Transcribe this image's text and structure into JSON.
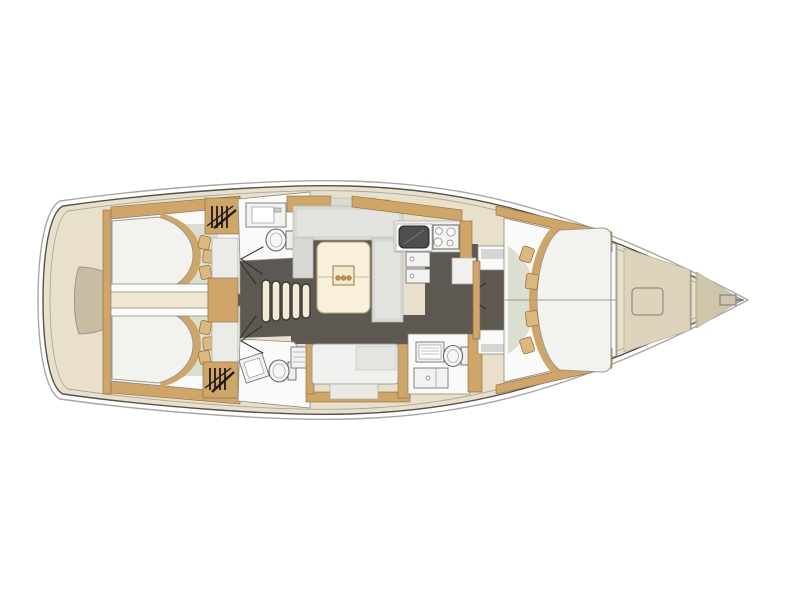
{
  "figure": {
    "type": "floor-plan-diagram",
    "subject": "sailing yacht interior layout, top-down view",
    "orientation": "bow pointing right, stern at left",
    "visible_text_labels": []
  },
  "palette": {
    "hullBeige": "#e9e0cb",
    "hullOutline": "#55524a",
    "deckLine": "#a8a8a0",
    "woodTan": "#d0a568",
    "woodDark": "#8a6a3c",
    "floorDark": "#5d5852",
    "roomWhite": "#fafaf8",
    "mattressWhite": "#f2f2ef",
    "seatGray": "#d7d7d4",
    "seatGrayLight": "#e3e3e0",
    "tableCream": "#f8f0da",
    "sage": "#dadfd0",
    "sternPad": "#c8bca2",
    "foredeckPanel": "#ded4bc",
    "anchorLocker": "#cfc5ab",
    "sinkDark": "#4e4e4e",
    "lineDark": "#2e2c28",
    "pillowTan": "#ddb87c",
    "outlineThin": "#8c8b84"
  },
  "areas": {
    "stern_platform": {
      "fixtures": [
        "swim-platform-pad"
      ]
    },
    "aft_cabin_port": {
      "fixtures": [
        "double-berth",
        "pillows-3",
        "hanging-locker-symbol",
        "side-unit"
      ]
    },
    "aft_cabin_starboard": {
      "fixtures": [
        "double-berth",
        "pillows-3",
        "hanging-locker-symbol",
        "side-unit"
      ]
    },
    "engine_compartment": {
      "fixtures": [
        "engine-box"
      ]
    },
    "companionway": {
      "steps": 5
    },
    "aft_head_port": {
      "fixtures": [
        "washbasin",
        "toilet"
      ]
    },
    "aft_head_starboard": {
      "fixtures": [
        "washbasin",
        "toilet",
        "shower-seat"
      ]
    },
    "salon": {
      "fixtures": [
        "u-shaped-settee",
        "table",
        "tray-with-3-cups"
      ]
    },
    "galley": {
      "fixtures": [
        "sink",
        "stove-4-burners",
        "fridge-drawer",
        "fridge-drawer",
        "counter"
      ]
    },
    "settee_starboard": {
      "fixtures": [
        "bench",
        "backrest",
        "footstool"
      ]
    },
    "forward_head": {
      "fixtures": [
        "vanity",
        "toilet",
        "cabinet-with-basin"
      ]
    },
    "forward_cabin": {
      "fixtures": [
        "v-berth",
        "pillows-4",
        "centerline"
      ]
    },
    "foredeck": {
      "fixtures": [
        "deck-hatch",
        "bulkhead",
        "anchor-locker",
        "anchor-roller"
      ]
    }
  }
}
